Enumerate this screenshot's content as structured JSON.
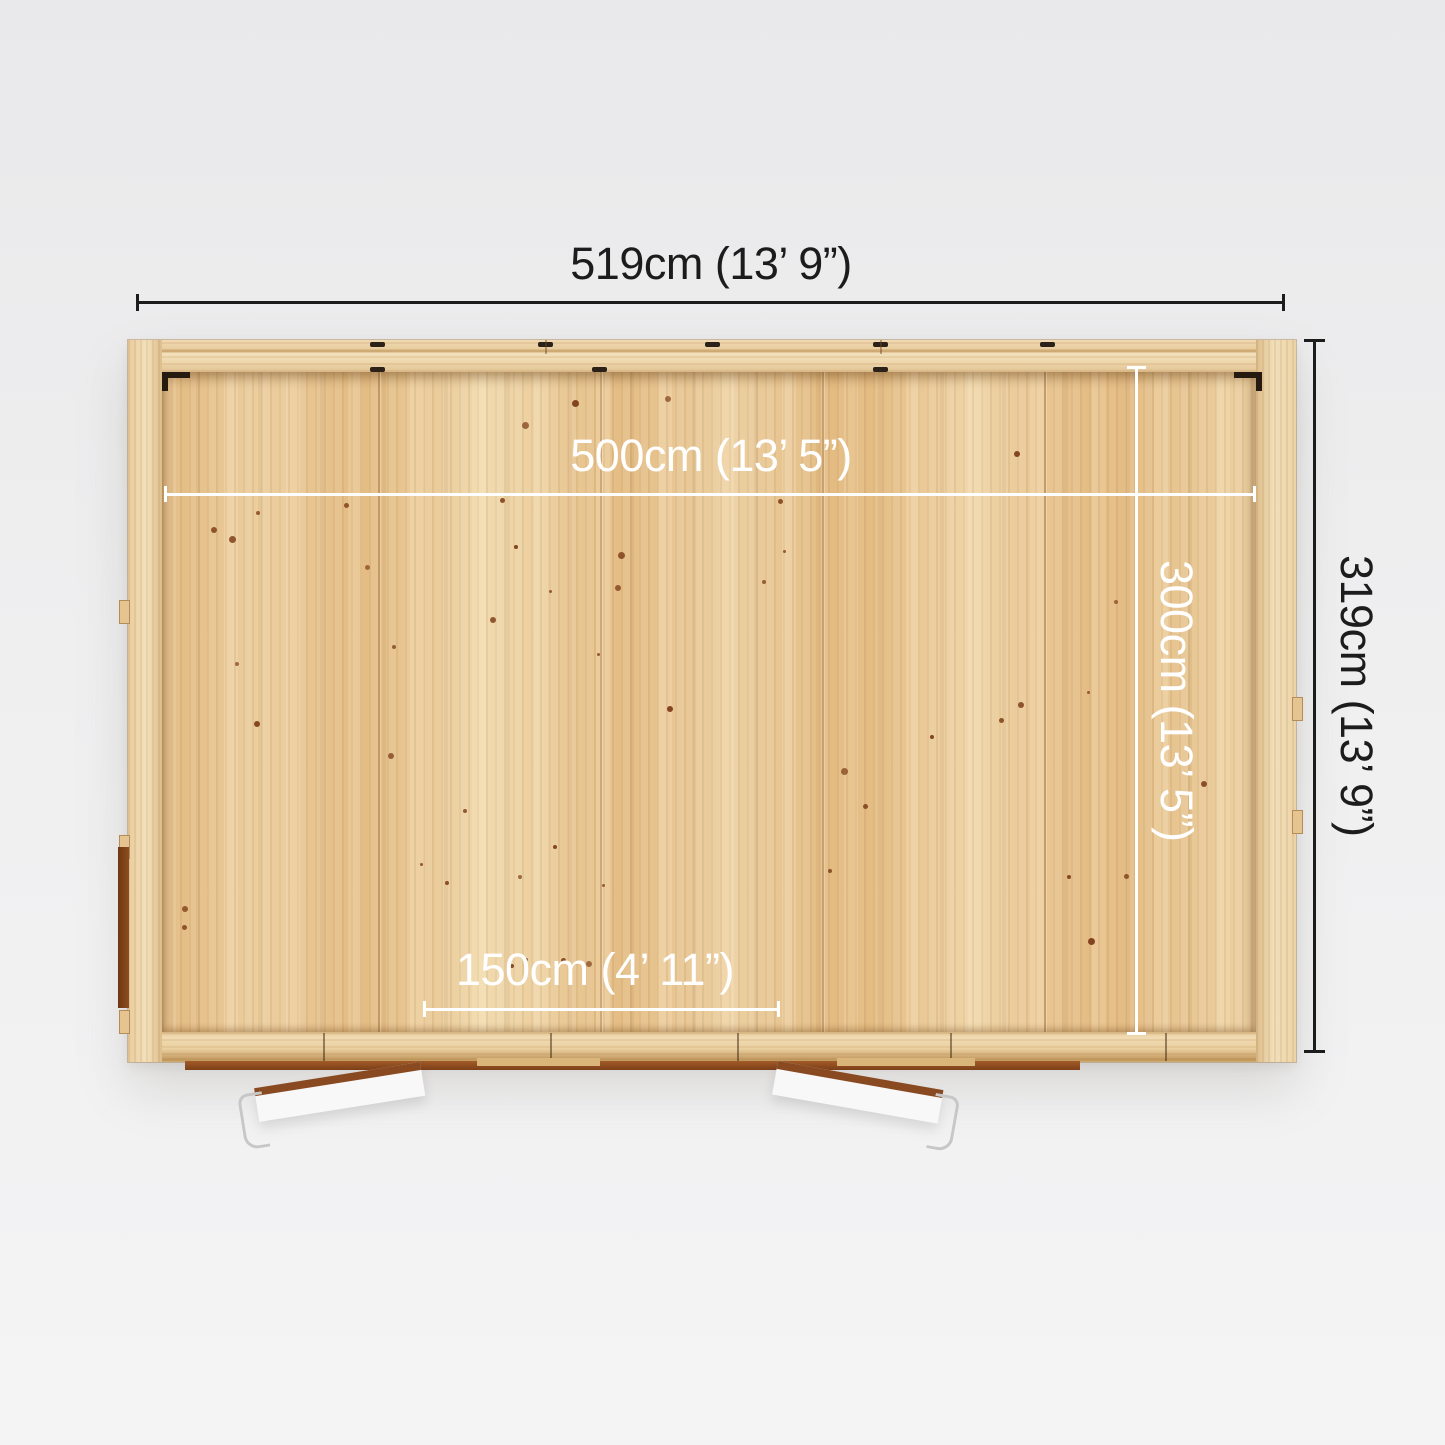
{
  "product_view": {
    "name": "garden-building-top-view-floor-plan"
  },
  "dimensions": {
    "external_width": "519cm (13’ 9”)",
    "external_depth": "319cm (13’ 9”)",
    "internal_width": "500cm (13’ 5”)",
    "internal_depth": "300cm (13’ 5”)",
    "door_opening_width": "150cm (4’ 11”)"
  },
  "colors": {
    "background": "#efeff0",
    "dimension_text_dark": "#1c1c1c",
    "dimension_text_light": "#ffffff",
    "wall_wood": "#eed7ae",
    "floor_wood": "#e8c795",
    "door_leaf_white": "#f8f8f8",
    "door_edge_brown": "#8a4a21",
    "threshold_brown": "#8f4d22"
  }
}
